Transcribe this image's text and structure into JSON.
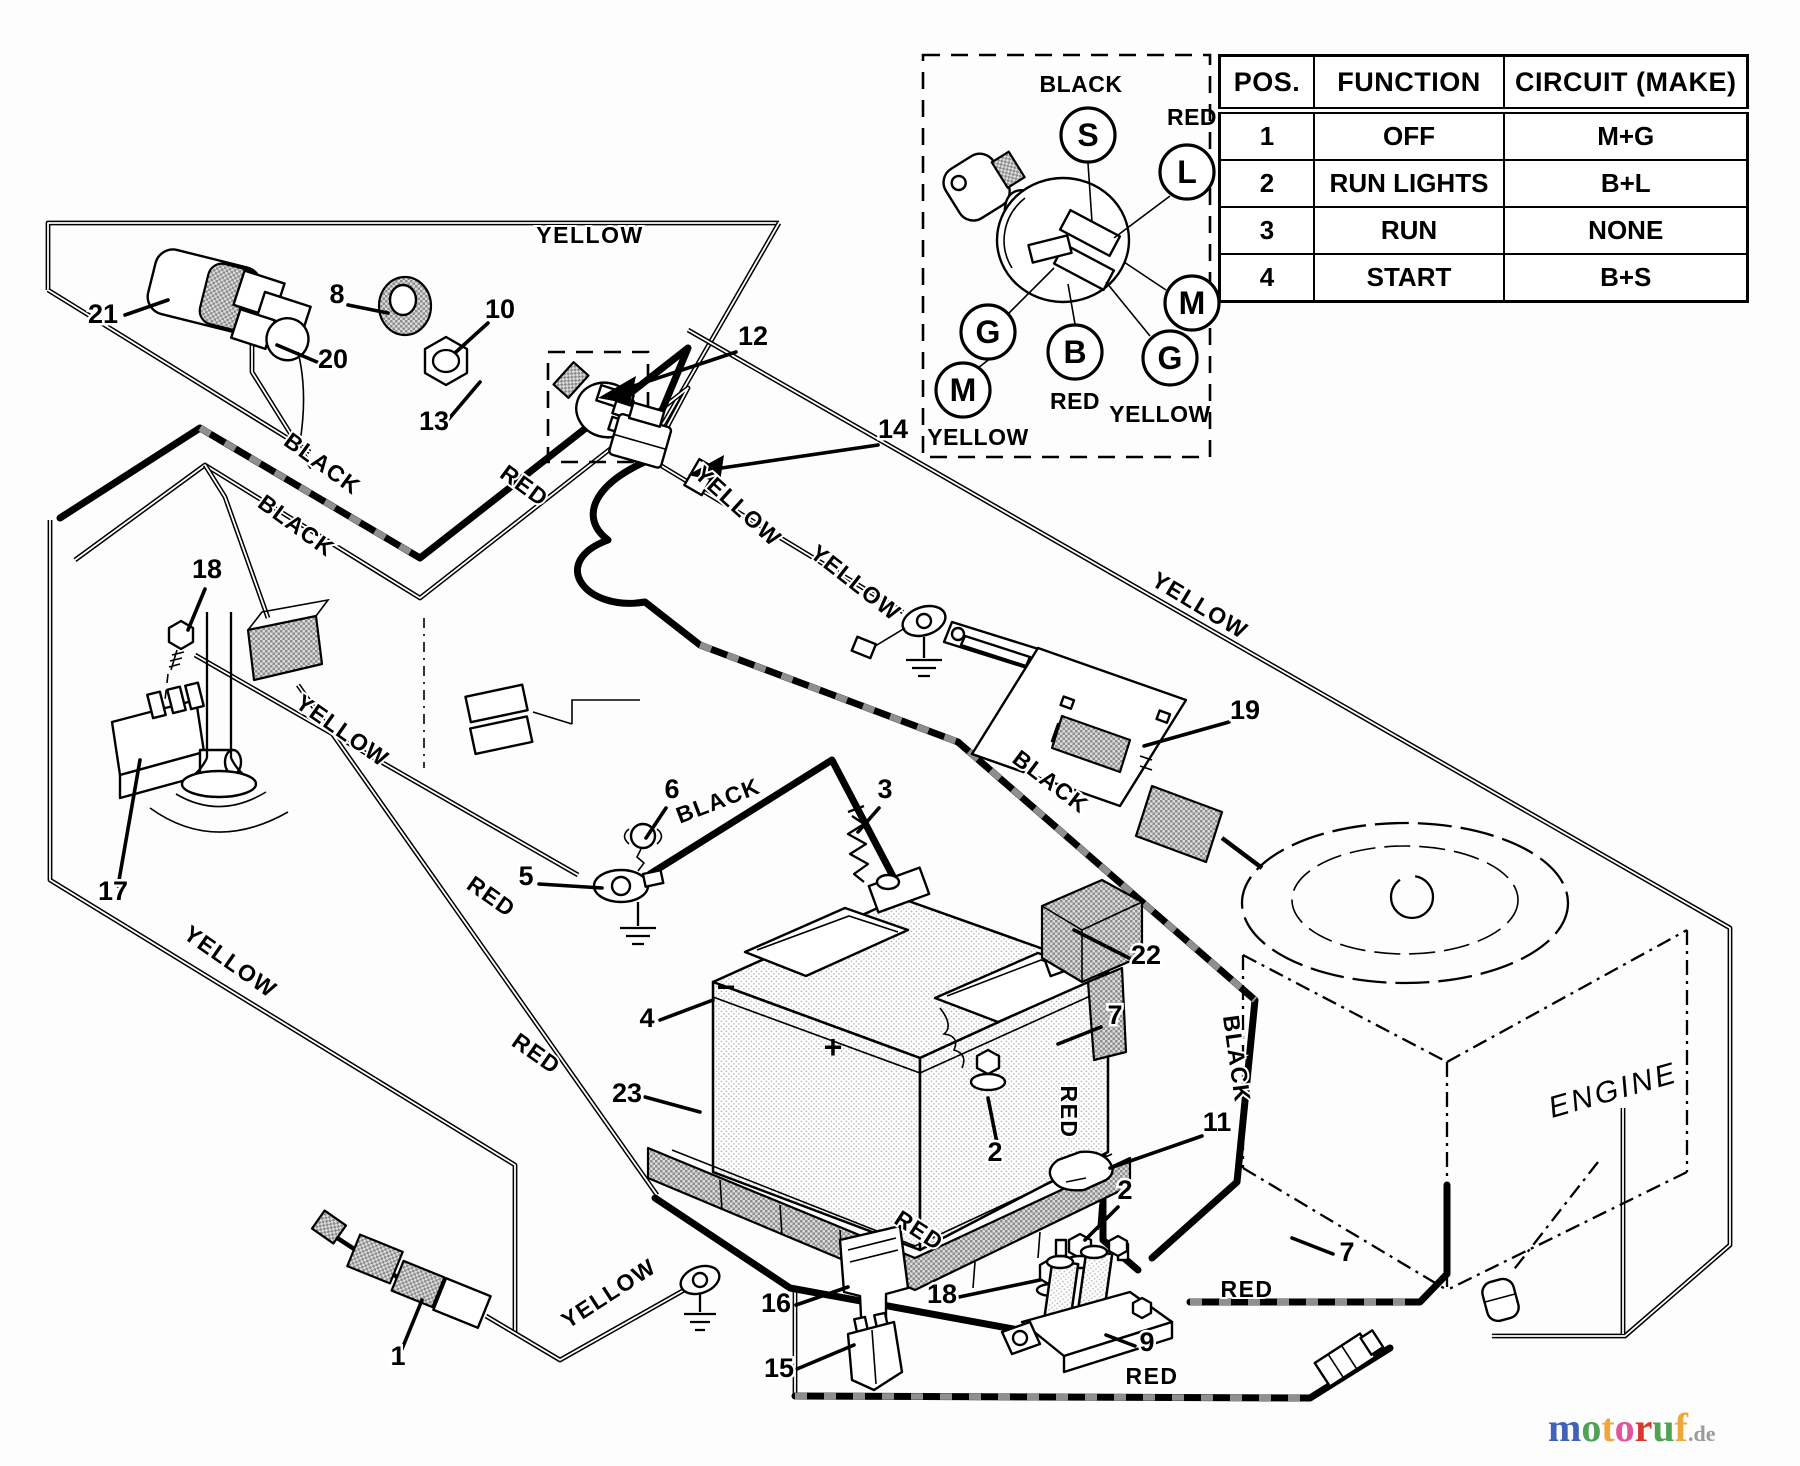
{
  "table": {
    "headers": [
      "POS.",
      "FUNCTION",
      "CIRCUIT (MAKE)"
    ],
    "rows": [
      [
        "1",
        "OFF",
        "M+G"
      ],
      [
        "2",
        "RUN LIGHTS",
        "B+L"
      ],
      [
        "3",
        "RUN",
        "NONE"
      ],
      [
        "4",
        "START",
        "B+S"
      ]
    ]
  },
  "ignition_switch_detail": {
    "terminals": [
      {
        "letter": "S",
        "x": 1088,
        "y": 135
      },
      {
        "letter": "L",
        "x": 1187,
        "y": 172
      },
      {
        "letter": "G",
        "x": 988,
        "y": 332
      },
      {
        "letter": "M",
        "x": 963,
        "y": 390
      },
      {
        "letter": "B",
        "x": 1075,
        "y": 352
      },
      {
        "letter": "M",
        "x": 1192,
        "y": 303
      },
      {
        "letter": "G",
        "x": 1170,
        "y": 358
      }
    ],
    "wire_colors": [
      {
        "text": "BLACK",
        "x": 1081,
        "y": 84
      },
      {
        "text": "RED",
        "x": 1192,
        "y": 117
      },
      {
        "text": "RED",
        "x": 1075,
        "y": 401
      },
      {
        "text": "YELLOW",
        "x": 1160,
        "y": 414
      },
      {
        "text": "YELLOW",
        "x": 978,
        "y": 437
      }
    ]
  },
  "wire_labels": [
    {
      "text": "YELLOW",
      "x": 590,
      "y": 243,
      "rot": 0
    },
    {
      "text": "BLACK",
      "x": 318,
      "y": 470,
      "rot": 36
    },
    {
      "text": "BLACK",
      "x": 292,
      "y": 532,
      "rot": 36
    },
    {
      "text": "RED",
      "x": 520,
      "y": 492,
      "rot": 36
    },
    {
      "text": "YELLOW",
      "x": 733,
      "y": 512,
      "rot": 42
    },
    {
      "text": "YELLOW",
      "x": 338,
      "y": 737,
      "rot": 35
    },
    {
      "text": "YELLOW",
      "x": 226,
      "y": 968,
      "rot": 35
    },
    {
      "text": "RED",
      "x": 487,
      "y": 903,
      "rot": 35
    },
    {
      "text": "RED",
      "x": 532,
      "y": 1060,
      "rot": 35
    },
    {
      "text": "BLACK",
      "x": 721,
      "y": 808,
      "rot": -21
    },
    {
      "text": "BLACK",
      "x": 1046,
      "y": 788,
      "rot": 37
    },
    {
      "text": "RED",
      "x": 1061,
      "y": 1112,
      "rot": 90
    },
    {
      "text": "BLACK",
      "x": 1229,
      "y": 1060,
      "rot": 82
    },
    {
      "text": "YELLOW",
      "x": 851,
      "y": 589,
      "rot": 38
    },
    {
      "text": "YELLOW",
      "x": 1196,
      "y": 612,
      "rot": 31
    },
    {
      "text": "RED",
      "x": 915,
      "y": 1237,
      "rot": 33
    },
    {
      "text": "RED",
      "x": 1247,
      "y": 1297,
      "rot": 0
    },
    {
      "text": "RED",
      "x": 1152,
      "y": 1384,
      "rot": 0
    },
    {
      "text": "YELLOW",
      "x": 613,
      "y": 1300,
      "rot": -33
    }
  ],
  "part_labels": [
    {
      "num": "21",
      "x": 103,
      "y": 313
    },
    {
      "num": "20",
      "x": 333,
      "y": 358
    },
    {
      "num": "8",
      "x": 337,
      "y": 293
    },
    {
      "num": "10",
      "x": 500,
      "y": 308
    },
    {
      "num": "12",
      "x": 753,
      "y": 335
    },
    {
      "num": "13",
      "x": 434,
      "y": 420
    },
    {
      "num": "14",
      "x": 893,
      "y": 428
    },
    {
      "num": "18",
      "x": 207,
      "y": 568
    },
    {
      "num": "17",
      "x": 113,
      "y": 890
    },
    {
      "num": "6",
      "x": 672,
      "y": 788
    },
    {
      "num": "5",
      "x": 526,
      "y": 875
    },
    {
      "num": "3",
      "x": 885,
      "y": 788
    },
    {
      "num": "4",
      "x": 647,
      "y": 1017
    },
    {
      "num": "23",
      "x": 627,
      "y": 1092
    },
    {
      "num": "22",
      "x": 1146,
      "y": 954
    },
    {
      "num": "7",
      "x": 1115,
      "y": 1014
    },
    {
      "num": "11",
      "x": 1217,
      "y": 1121
    },
    {
      "num": "2",
      "x": 995,
      "y": 1151
    },
    {
      "num": "2",
      "x": 1125,
      "y": 1189
    },
    {
      "num": "16",
      "x": 776,
      "y": 1302
    },
    {
      "num": "15",
      "x": 779,
      "y": 1367
    },
    {
      "num": "18",
      "x": 942,
      "y": 1293
    },
    {
      "num": "9",
      "x": 1147,
      "y": 1341
    },
    {
      "num": "19",
      "x": 1245,
      "y": 709
    },
    {
      "num": "1",
      "x": 398,
      "y": 1355
    },
    {
      "num": "7",
      "x": 1347,
      "y": 1251
    }
  ],
  "engine": {
    "label": "ENGINE"
  },
  "battery": {
    "minus": "−",
    "plus": "+"
  },
  "watermark": {
    "letters": [
      {
        "ch": "m",
        "color": "#3f63b5"
      },
      {
        "ch": "o",
        "color": "#4fa155"
      },
      {
        "ch": "t",
        "color": "#eea73b"
      },
      {
        "ch": "o",
        "color": "#e0559c"
      },
      {
        "ch": "r",
        "color": "#d6372e"
      },
      {
        "ch": "u",
        "color": "#4fa155"
      },
      {
        "ch": "f",
        "color": "#eea73b"
      }
    ],
    "suffix": ".de",
    "suffix_color": "#9a9a9a"
  }
}
